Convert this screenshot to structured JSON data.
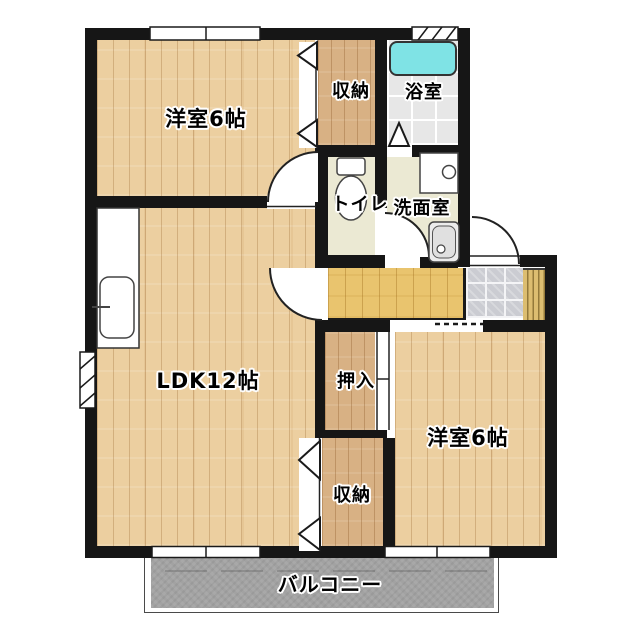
{
  "floorplan": {
    "labels": {
      "bedroom_top_left": "洋室6帖",
      "storage_top": "収納",
      "bathroom": "浴室",
      "toilet": "トイレ",
      "washroom": "洗面室",
      "ldk": "LDK12帖",
      "oshiire": "押入",
      "bedroom_bottom_right": "洋室6帖",
      "storage_bottom": "収納",
      "balcony": "バルコニー"
    },
    "colors": {
      "wall": "#161616",
      "wood-light": "#eccfa0",
      "wood-dark": "#d8b184",
      "wood-hall": "#e9c46e",
      "bath-tile": "#e7e7e7",
      "bathtub": "#7fe3e5",
      "pale-floor": "#ebe9d3",
      "genkan-tile": "#cbccd2",
      "balcony": "#a2a2a2",
      "bg": "#ffffff"
    }
  }
}
